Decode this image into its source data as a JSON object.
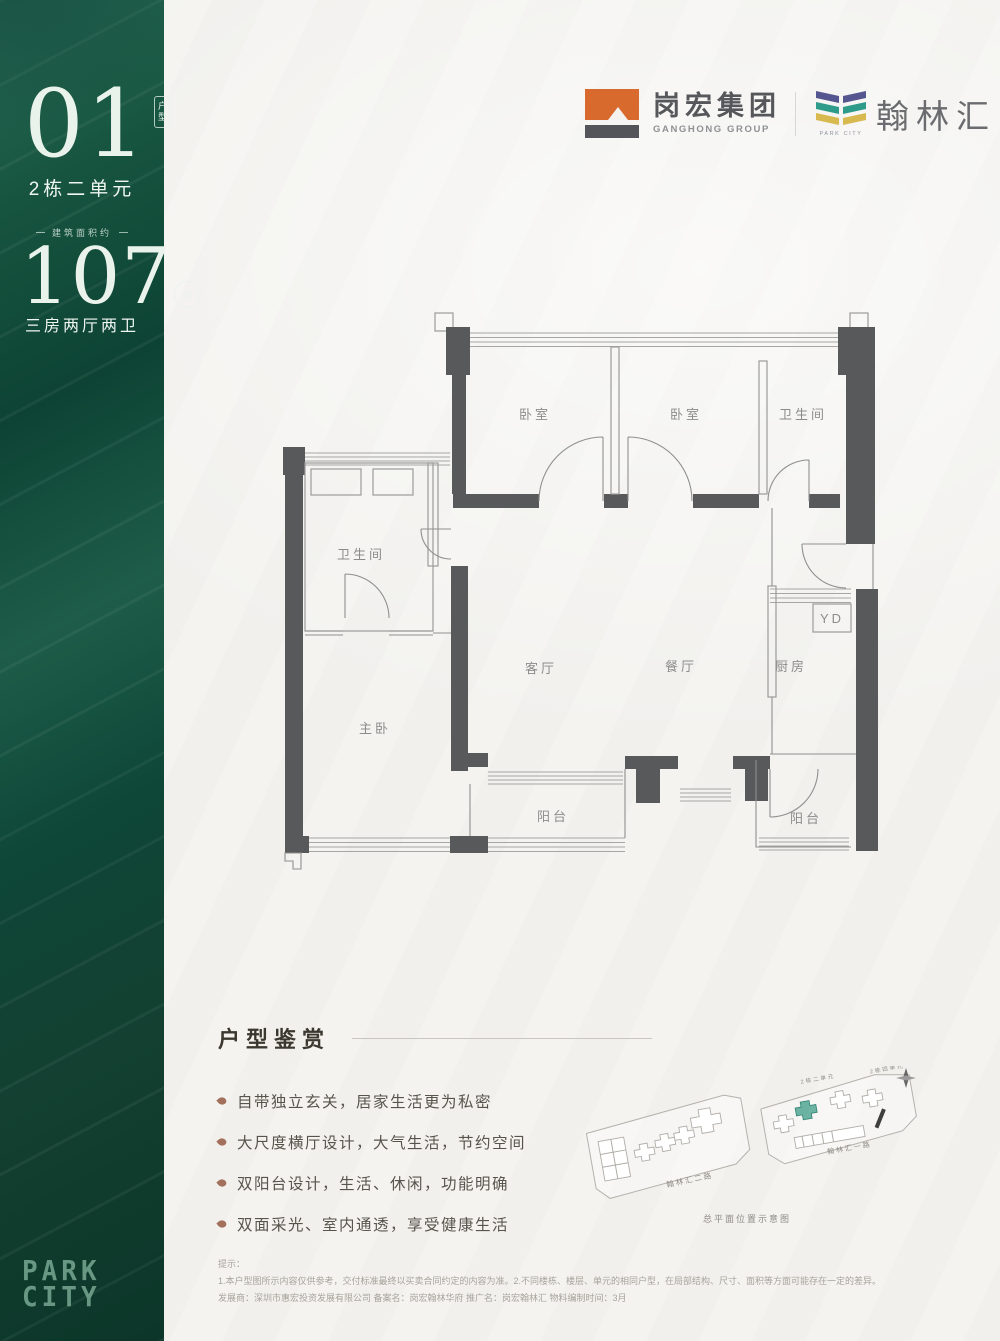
{
  "sidebar": {
    "unit_number": "01",
    "unit_badge": "户型",
    "unit_name": "2栋二单元",
    "area_label": "建筑面积约",
    "area_value": "107",
    "area_unit": "㎡",
    "layout": "三房两厅两卫",
    "brand_line1": "PARK",
    "brand_line2": "CITY"
  },
  "header": {
    "developer": {
      "name": "岗宏集团",
      "sub": "GANGHONG GROUP"
    },
    "project": {
      "name": "翰林汇",
      "sub": "PARK CITY"
    }
  },
  "colors": {
    "sidebar_green_dark": "#0b3629",
    "sidebar_green_light": "#2a6f59",
    "logo_orange": "#d96a2d",
    "logo_gray": "#54555a",
    "stripe_purple": "#55568f",
    "stripe_teal": "#2f9b8a",
    "stripe_yellow": "#d7b94f",
    "siteplan_highlight": "#49a18f",
    "wall_gray": "#58595b"
  },
  "floorplan": {
    "rooms": [
      {
        "id": "bedroom-1",
        "label": "卧室"
      },
      {
        "id": "bedroom-2",
        "label": "卧室"
      },
      {
        "id": "bath-top",
        "label": "卫生间"
      },
      {
        "id": "bath-left",
        "label": "卫生间"
      },
      {
        "id": "master-bedroom",
        "label": "主卧"
      },
      {
        "id": "living-room",
        "label": "客厅"
      },
      {
        "id": "dining-room",
        "label": "餐厅"
      },
      {
        "id": "kitchen",
        "label": "厨房"
      },
      {
        "id": "yd",
        "label": "YD"
      },
      {
        "id": "balcony-center",
        "label": "阳台"
      },
      {
        "id": "balcony-right",
        "label": "阳台"
      }
    ]
  },
  "features": {
    "title": "户型鉴赏",
    "items": [
      "自带独立玄关，居家生活更为私密",
      "大尺度横厅设计，大气生活，节约空间",
      "双阳台设计，生活、休闲，功能明确",
      "双面采光、室内通透，享受健康生活"
    ]
  },
  "siteplan": {
    "road_left": "翰林汇二路",
    "road_right": "翰林汇一路",
    "building_label_1": "2栋二单元",
    "building_label_2": "2栋四单元",
    "caption": "总平面位置示意图"
  },
  "disclaimer": {
    "title": "提示：",
    "line1": "1.本户型图所示内容仅供参考，交付标准最终以买卖合同约定的内容为准。2.不同楼栋、楼层、单元的相同户型，在局部结构、尺寸、面积等方面可能存在一定的差异。",
    "line2": "发展商：深圳市惠宏投资发展有限公司 备案名：岗宏翰林华府 推广名：岗宏翰林汇 物料编制时间：3月"
  }
}
